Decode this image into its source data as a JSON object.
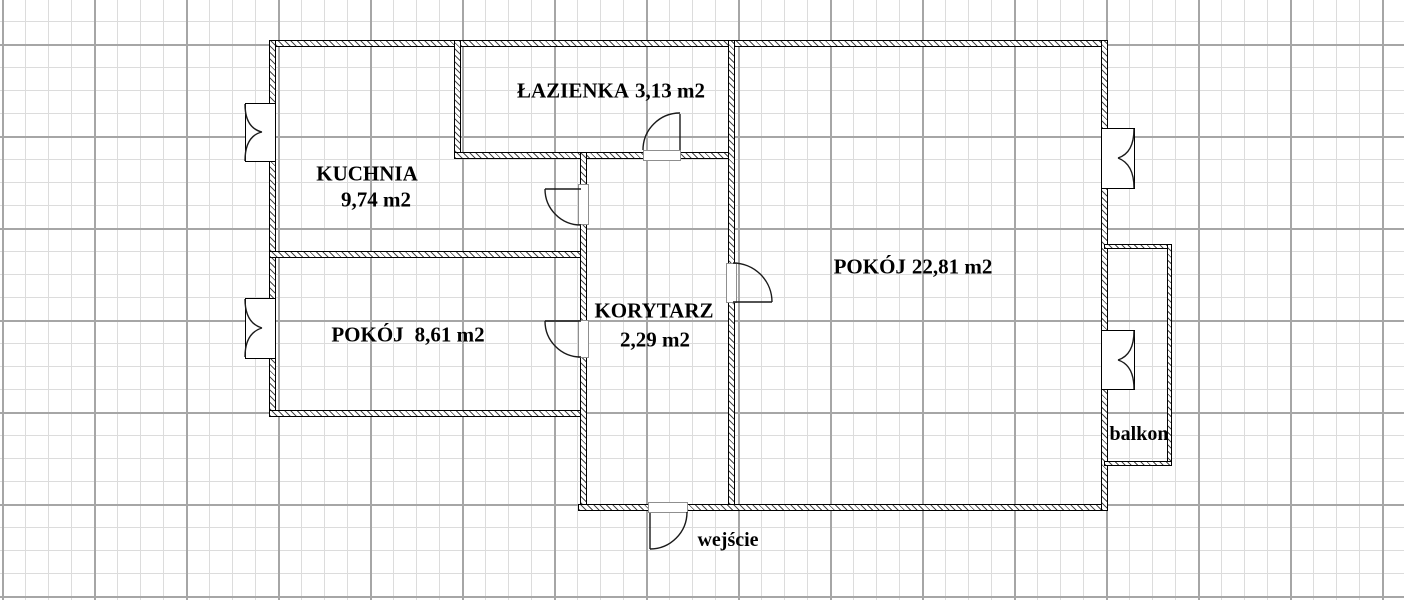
{
  "plan_title": "apartment floor plan",
  "rooms": [
    {
      "id": "lazienka",
      "name": "ŁAZIENKA",
      "area": "3,13 m2"
    },
    {
      "id": "kuchnia",
      "name": "KUCHNIA",
      "area": "9,74 m2"
    },
    {
      "id": "pokoj-maly",
      "name": "POKÓJ",
      "area": "8,61 m2"
    },
    {
      "id": "korytarz",
      "name": "KORYTARZ",
      "area": "2,29 m2"
    },
    {
      "id": "pokoj-duzy",
      "name": "POKÓJ",
      "area": "22,81 m2"
    }
  ],
  "annotations": {
    "balcony": "balkon",
    "entrance": "wejście"
  },
  "features": {
    "doors": [
      "bathroom-door",
      "kitchen-door",
      "small-room-door",
      "large-room-door",
      "entrance-door"
    ],
    "windows": [
      "kitchen-window",
      "small-room-window",
      "large-room-window",
      "balcony-door-window"
    ]
  },
  "colors": {
    "background": "#ffffff",
    "grid_minor": "#dcdcdc",
    "grid_major": "#a6a6a6",
    "wall_outline": "#000000",
    "wall_hatch": "#4a4a4a",
    "text": "#000000"
  }
}
